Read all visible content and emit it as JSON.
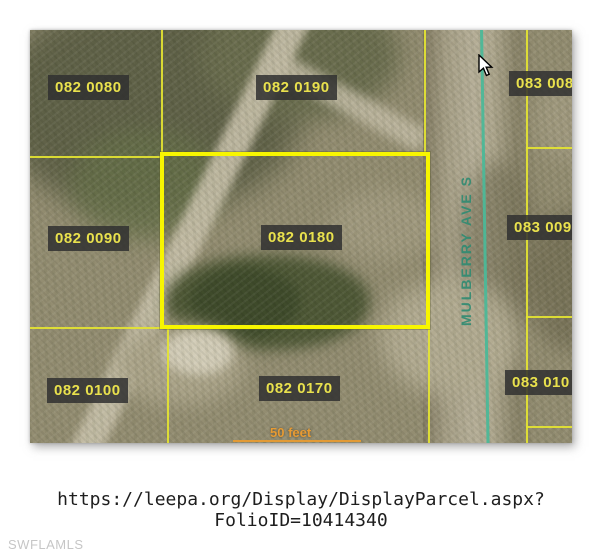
{
  "map": {
    "labels": [
      {
        "text": "082 0080"
      },
      {
        "text": "082 0190"
      },
      {
        "text": "083 008"
      },
      {
        "text": "082 0090"
      },
      {
        "text": "082 0180"
      },
      {
        "text": "083 009"
      },
      {
        "text": "082 0100"
      },
      {
        "text": "082 0170"
      },
      {
        "text": "083 010"
      }
    ],
    "selected_parcel": "082 0180",
    "street_label": "MULBERRY AVE S",
    "scale_label": "50 feet",
    "colors": {
      "parcel_line": "#e4e432",
      "selected_parcel_border": "#f8f600",
      "street_centerline": "#4cb898",
      "street_text": "#2f8b72",
      "label_background": "#303030",
      "label_text": "#e9e14d",
      "scale_text": "#e79b33"
    }
  },
  "caption": {
    "url_line1": "https://leepa.org/Display/DisplayParcel.aspx?",
    "url_line2": "FolioID=10414340"
  },
  "watermark": "SWFLAMLS"
}
